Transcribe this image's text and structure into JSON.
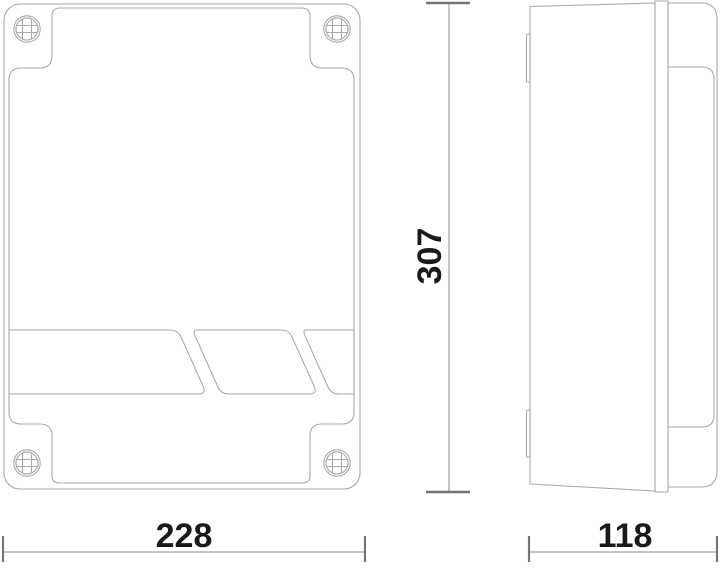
{
  "drawing": {
    "dimensions": {
      "width": {
        "value": "228"
      },
      "height": {
        "value": "307"
      },
      "depth": {
        "value": "118"
      }
    },
    "colors": {
      "background": "#ffffff",
      "outline": "#a9a9a9",
      "dimension_line": "#8d8d8d",
      "dimension_tick": "#757575",
      "text": "#1a1a1a"
    }
  }
}
